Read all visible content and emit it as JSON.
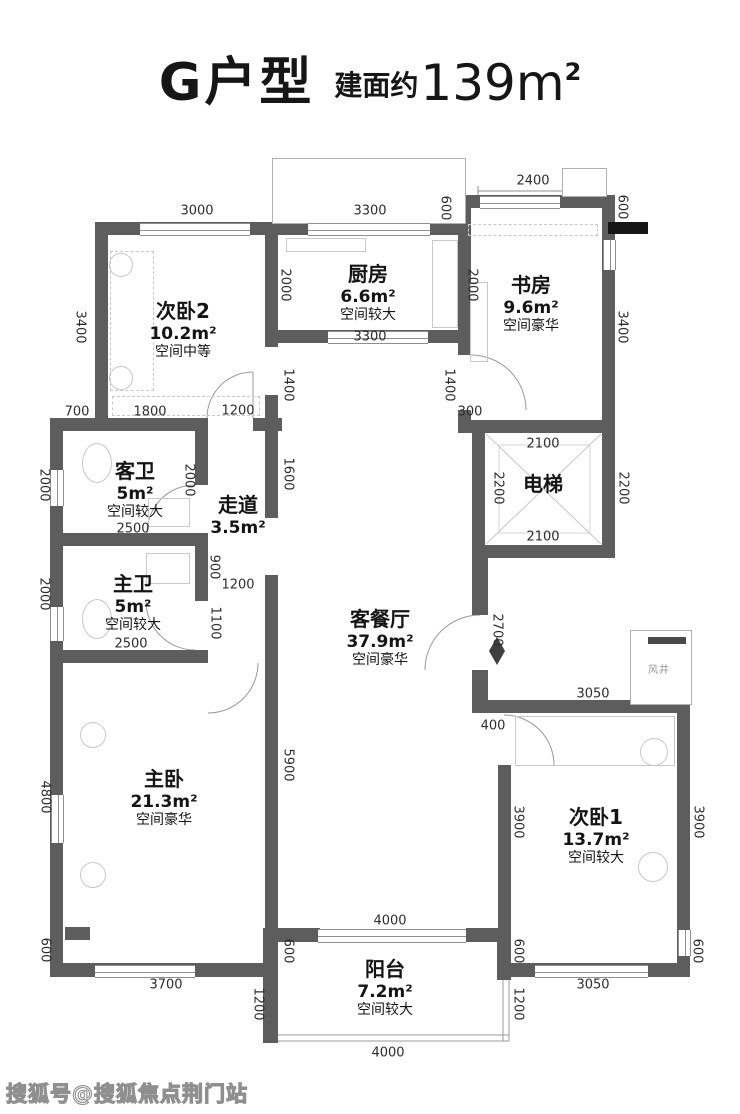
{
  "title": {
    "name": "G户型",
    "area_prefix": "建面约",
    "area_value": "139",
    "area_unit": "m",
    "area_sup": "2"
  },
  "watermark": "搜狐号@搜狐焦点荆门站",
  "colors": {
    "wall": "#5d5d5d",
    "dim_text": "#2d2d2d",
    "light_line": "#bdbdbd",
    "black_marker": "#161616"
  },
  "rooms": [
    {
      "id": "bedroom2",
      "name": "次卧2",
      "area": "10.2m²",
      "grade": "空间中等",
      "x": 183,
      "y": 300
    },
    {
      "id": "kitchen",
      "name": "厨房",
      "area": "6.6m²",
      "grade": "空间较大",
      "x": 368,
      "y": 263
    },
    {
      "id": "study",
      "name": "书房",
      "area": "9.6m²",
      "grade": "空间豪华",
      "x": 531,
      "y": 274
    },
    {
      "id": "guest-bathroom",
      "name": "客卫",
      "area": "5m²",
      "grade": "空间较大",
      "x": 135,
      "y": 460
    },
    {
      "id": "corridor",
      "name": "走道",
      "area": "3.5m²",
      "grade": "",
      "x": 238,
      "y": 494
    },
    {
      "id": "master-bathroom",
      "name": "主卫",
      "area": "5m²",
      "grade": "空间较大",
      "x": 133,
      "y": 573
    },
    {
      "id": "elevator",
      "name": "电梯",
      "area": "",
      "grade": "",
      "x": 543,
      "y": 473
    },
    {
      "id": "living-dining",
      "name": "客餐厅",
      "area": "37.9m²",
      "grade": "空间豪华",
      "x": 380,
      "y": 608
    },
    {
      "id": "master-bedroom",
      "name": "主卧",
      "area": "21.3m²",
      "grade": "空间豪华",
      "x": 164,
      "y": 768
    },
    {
      "id": "bedroom1",
      "name": "次卧1",
      "area": "13.7m²",
      "grade": "空间较大",
      "x": 596,
      "y": 806
    },
    {
      "id": "balcony",
      "name": "阳台",
      "area": "7.2m²",
      "grade": "空间较大",
      "x": 385,
      "y": 958
    },
    {
      "id": "air-shaft",
      "name": "风井",
      "area": "",
      "grade": "",
      "x": 659,
      "y": 665,
      "small": true
    }
  ],
  "dimensions": [
    {
      "v": "3000",
      "x": 197,
      "y": 211,
      "o": "h"
    },
    {
      "v": "3300",
      "x": 370,
      "y": 211,
      "o": "h"
    },
    {
      "v": "2400",
      "x": 533,
      "y": 181,
      "o": "h"
    },
    {
      "v": "600",
      "x": 445,
      "y": 208,
      "o": "v"
    },
    {
      "v": "600",
      "x": 622,
      "y": 207,
      "o": "v"
    },
    {
      "v": "3400",
      "x": 80,
      "y": 327,
      "o": "v"
    },
    {
      "v": "2000",
      "x": 285,
      "y": 285,
      "o": "v"
    },
    {
      "v": "2000",
      "x": 472,
      "y": 285,
      "o": "v"
    },
    {
      "v": "3400",
      "x": 622,
      "y": 327,
      "o": "v"
    },
    {
      "v": "3300",
      "x": 370,
      "y": 337,
      "o": "h"
    },
    {
      "v": "1400",
      "x": 288,
      "y": 385,
      "o": "v"
    },
    {
      "v": "1400",
      "x": 449,
      "y": 385,
      "o": "v"
    },
    {
      "v": "300",
      "x": 470,
      "y": 412,
      "o": "h"
    },
    {
      "v": "700",
      "x": 77,
      "y": 412,
      "o": "h"
    },
    {
      "v": "1800",
      "x": 150,
      "y": 412,
      "o": "h"
    },
    {
      "v": "1200",
      "x": 238,
      "y": 411,
      "o": "h"
    },
    {
      "v": "2000",
      "x": 44,
      "y": 485,
      "o": "v"
    },
    {
      "v": "2000",
      "x": 189,
      "y": 480,
      "o": "v"
    },
    {
      "v": "1600",
      "x": 288,
      "y": 474,
      "o": "v"
    },
    {
      "v": "2100",
      "x": 543,
      "y": 444,
      "o": "h"
    },
    {
      "v": "2200",
      "x": 498,
      "y": 488,
      "o": "v"
    },
    {
      "v": "2200",
      "x": 623,
      "y": 488,
      "o": "v"
    },
    {
      "v": "2100",
      "x": 543,
      "y": 537,
      "o": "h"
    },
    {
      "v": "2500",
      "x": 133,
      "y": 529,
      "o": "h"
    },
    {
      "v": "900",
      "x": 214,
      "y": 567,
      "o": "v"
    },
    {
      "v": "2000",
      "x": 44,
      "y": 594,
      "o": "v"
    },
    {
      "v": "1200",
      "x": 238,
      "y": 585,
      "o": "h"
    },
    {
      "v": "1100",
      "x": 215,
      "y": 623,
      "o": "v"
    },
    {
      "v": "2500",
      "x": 131,
      "y": 644,
      "o": "h"
    },
    {
      "v": "2700",
      "x": 497,
      "y": 630,
      "o": "v"
    },
    {
      "v": "3050",
      "x": 593,
      "y": 694,
      "o": "h"
    },
    {
      "v": "400",
      "x": 493,
      "y": 726,
      "o": "h"
    },
    {
      "v": "5900",
      "x": 288,
      "y": 765,
      "o": "v"
    },
    {
      "v": "4800",
      "x": 45,
      "y": 797,
      "o": "v"
    },
    {
      "v": "3900",
      "x": 518,
      "y": 822,
      "o": "v"
    },
    {
      "v": "3900",
      "x": 698,
      "y": 822,
      "o": "v"
    },
    {
      "v": "600",
      "x": 45,
      "y": 950,
      "o": "v"
    },
    {
      "v": "600",
      "x": 288,
      "y": 951,
      "o": "v"
    },
    {
      "v": "600",
      "x": 518,
      "y": 951,
      "o": "v"
    },
    {
      "v": "600",
      "x": 697,
      "y": 951,
      "o": "v"
    },
    {
      "v": "3700",
      "x": 166,
      "y": 985,
      "o": "h"
    },
    {
      "v": "1200",
      "x": 258,
      "y": 1004,
      "o": "v"
    },
    {
      "v": "4000",
      "x": 390,
      "y": 921,
      "o": "h"
    },
    {
      "v": "1200",
      "x": 518,
      "y": 1004,
      "o": "v"
    },
    {
      "v": "3050",
      "x": 593,
      "y": 985,
      "o": "h"
    },
    {
      "v": "4000",
      "x": 388,
      "y": 1053,
      "o": "h"
    }
  ]
}
